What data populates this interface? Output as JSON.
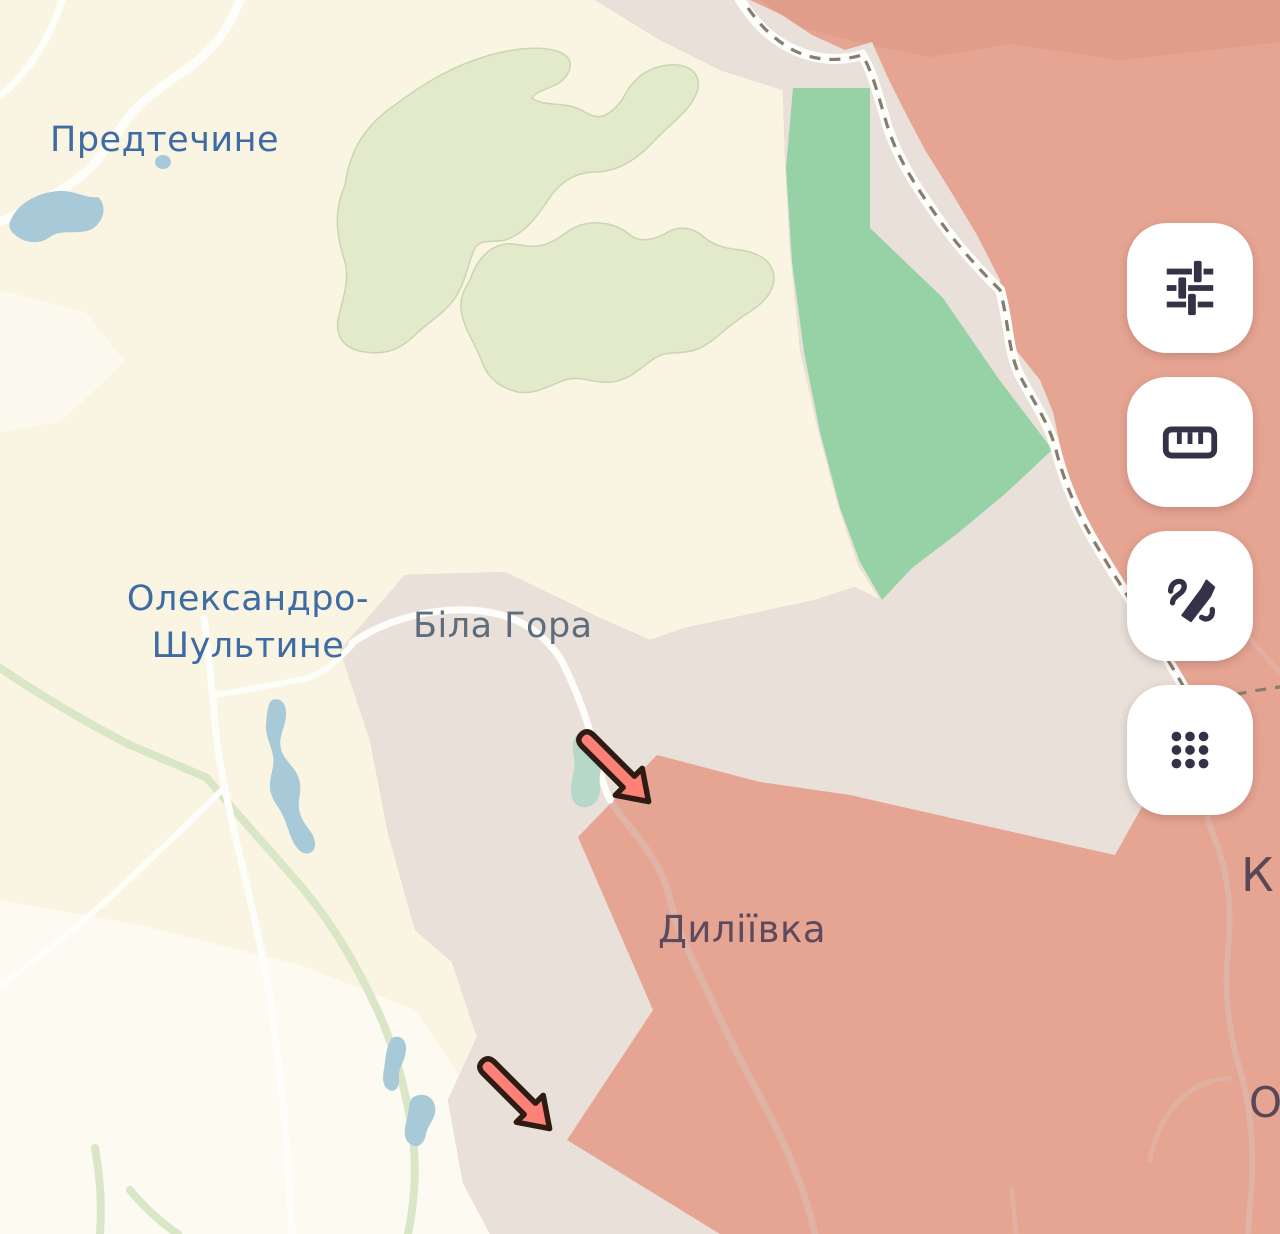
{
  "map": {
    "labels": [
      {
        "id": "predtechyne",
        "text": "Предтечине",
        "color": "#3d6ba4"
      },
      {
        "id": "oleksandro-shultyne",
        "text": "Олександро-\nШультине",
        "color": "#3d6ba4"
      },
      {
        "id": "bila-hora",
        "text": "Біла Гора",
        "color": "#5e6c7b"
      },
      {
        "id": "dyliivka",
        "text": "Диліївка",
        "color": "#5d4a5c"
      },
      {
        "id": "partial-town-k",
        "text": "К",
        "color": "#594755"
      },
      {
        "id": "partial-town-o",
        "text": "О",
        "color": "#594755"
      }
    ],
    "zones": {
      "base_terrain": {
        "name": "ukrainian-controlled",
        "color": "#faf5e2"
      },
      "light_fields": {
        "name": "light-fields",
        "color": "#fdfbf1"
      },
      "forest": {
        "name": "forest",
        "color": "#e2eacb"
      },
      "occupied": {
        "name": "russian-occupied",
        "color": "#e6a493"
      },
      "occupied_dark": {
        "name": "occupied-darker-patch",
        "color": "#d9957f"
      },
      "gray_zone": {
        "name": "contested-gray-zone",
        "color": "#e9e0d9"
      },
      "liberated_green": {
        "name": "green-zone",
        "color": "#96d2a6"
      },
      "water": {
        "name": "water",
        "color": "#a8cad8"
      },
      "pond_teal": {
        "name": "pond",
        "color": "#b7d7c9"
      },
      "stream": {
        "name": "stream",
        "color": "#d8e6c4"
      },
      "road": {
        "name": "road",
        "color": "#fdfdfa"
      },
      "road_red_zone": {
        "name": "road-in-occupied-zone",
        "color": "#dfb3a5"
      },
      "boundary_dash": {
        "name": "admin-boundary",
        "color": "#877d6f"
      }
    },
    "arrows": {
      "color": "#fd8177",
      "outline": "#2e1c14",
      "items": [
        {
          "id": "attack-arrow-1",
          "direction": "northwest",
          "tip_x": 650,
          "tip_y": 803
        },
        {
          "id": "attack-arrow-2",
          "direction": "northwest",
          "tip_x": 551,
          "tip_y": 1130
        }
      ]
    }
  },
  "toolbar": {
    "icon_color": "#333247",
    "buttons": [
      {
        "name": "map-filters",
        "icon": "sliders-icon"
      },
      {
        "name": "measure-distance",
        "icon": "ruler-icon"
      },
      {
        "name": "draw-annotate",
        "icon": "signature-pen-icon"
      },
      {
        "name": "apps-grid",
        "icon": "dots-grid-icon"
      }
    ]
  }
}
